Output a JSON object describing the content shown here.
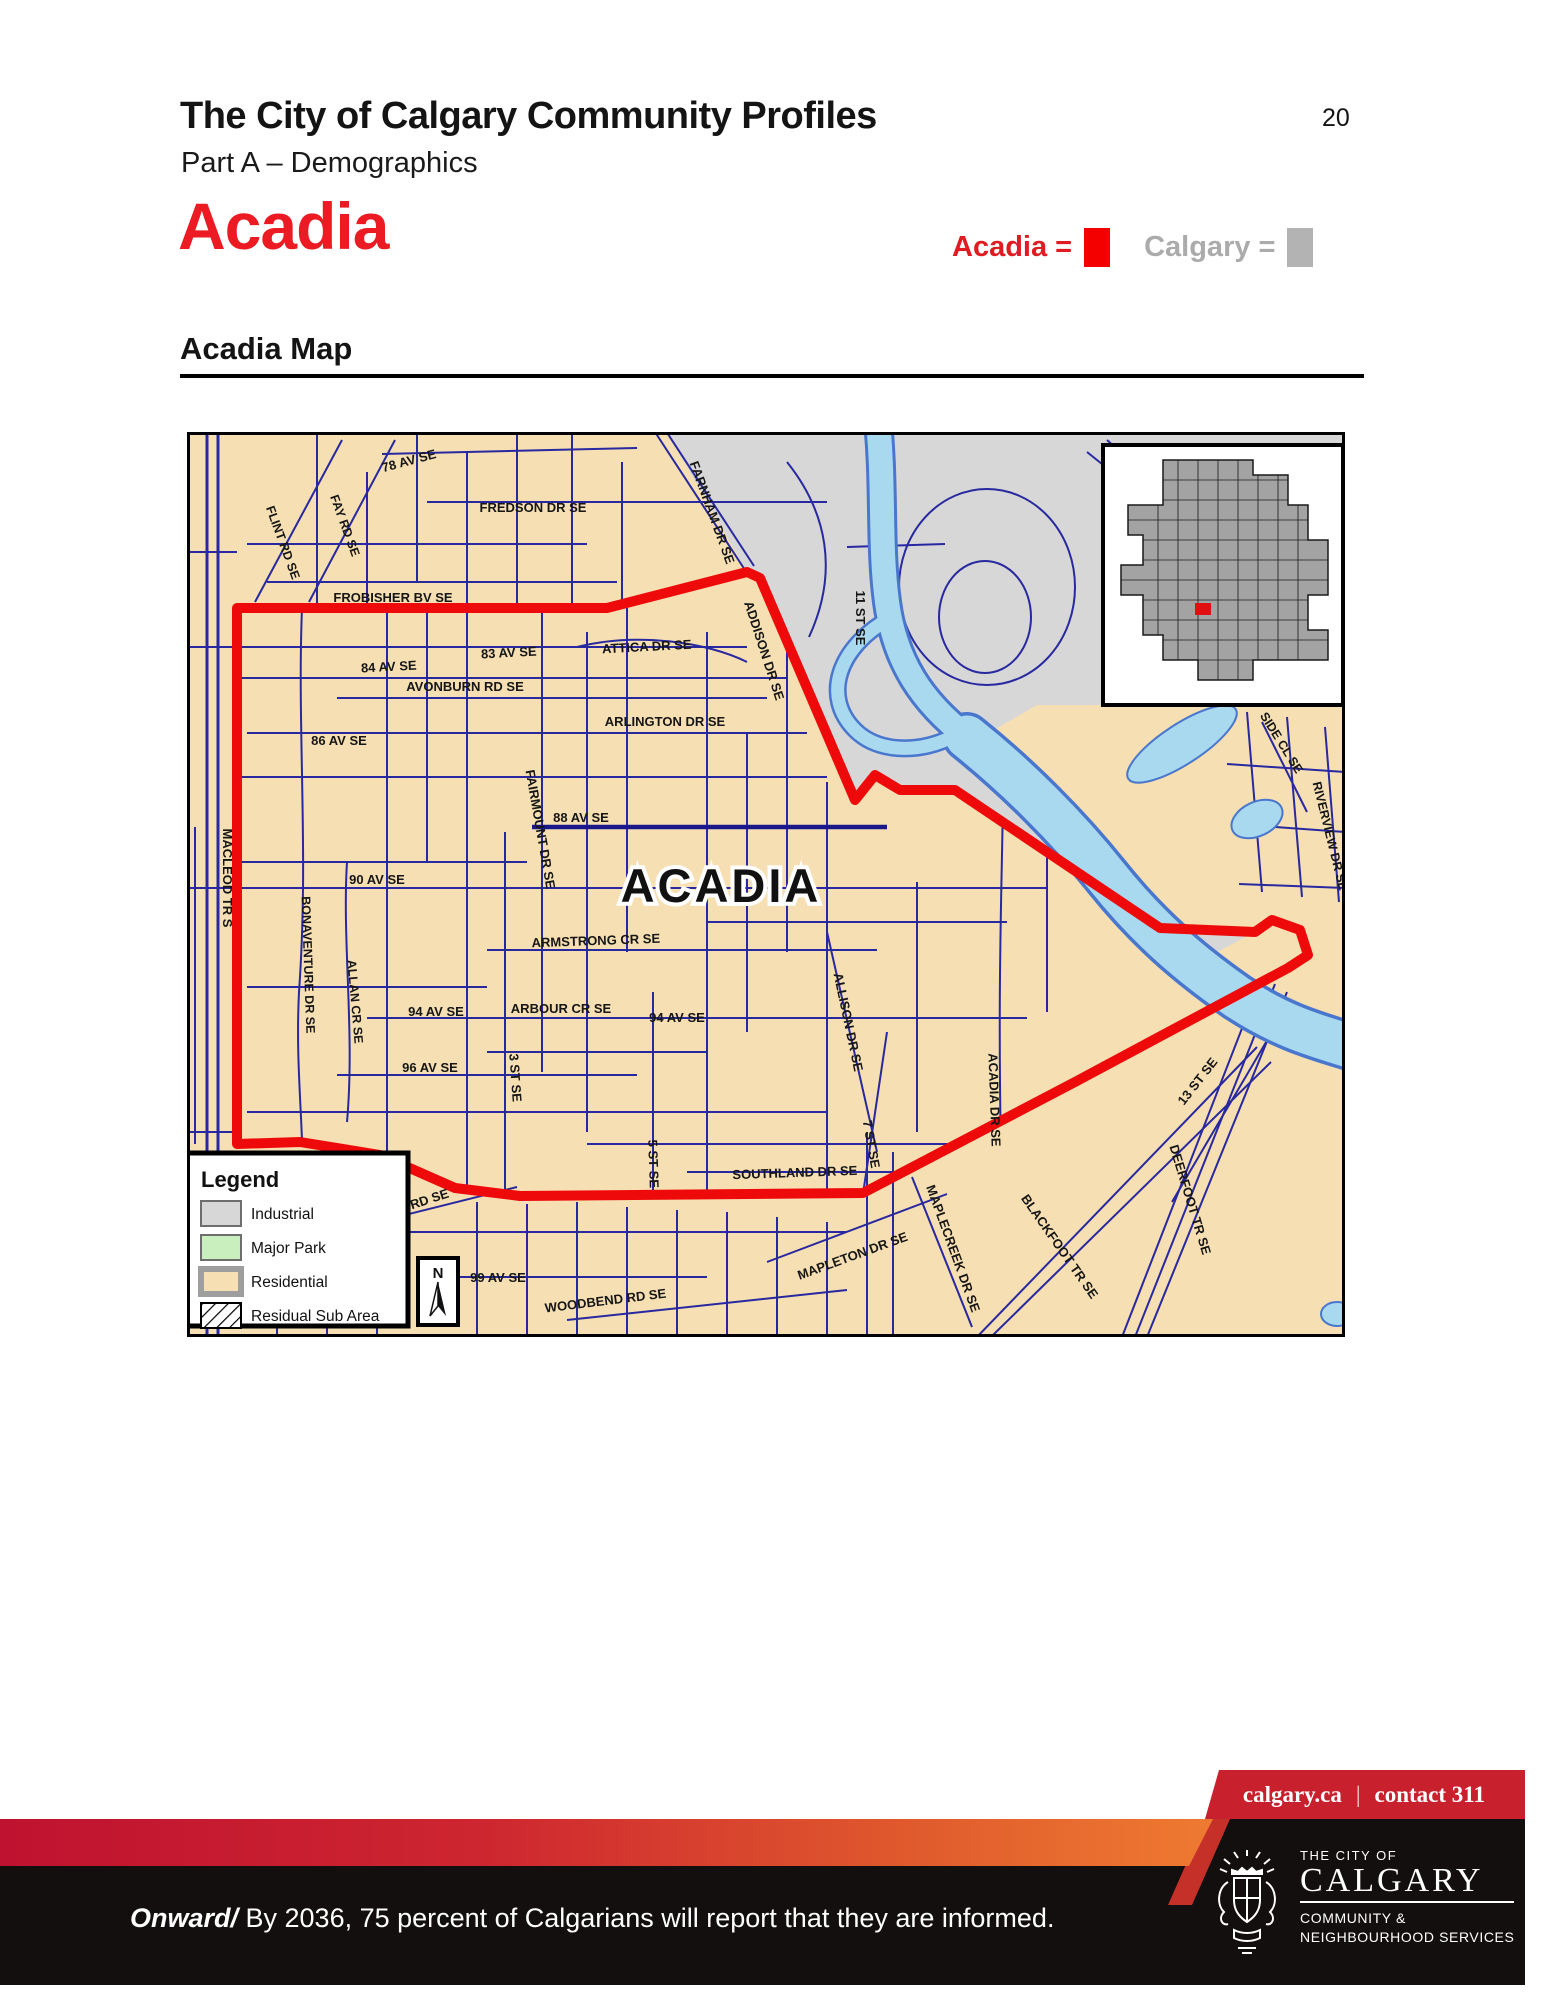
{
  "page": {
    "title": "The City of Calgary Community Profiles",
    "subtitle": "Part A – Demographics",
    "page_number": "20",
    "community_title": "Acadia",
    "map_heading": "Acadia Map"
  },
  "swatch_legend": {
    "acadia_label": "Acadia =",
    "calgary_label": "Calgary =",
    "acadia_color": "#f40000",
    "calgary_color": "#b3b3b3"
  },
  "map": {
    "community_label": "ACADIA",
    "colors": {
      "residential": "#f6dfb2",
      "industrial": "#d7d7d7",
      "major_park": "#c9efbe",
      "water_fill": "#a9d9ef",
      "water_edge": "#4a77ce",
      "street": "#2828a0",
      "boundary": "#ee0a0a"
    },
    "legend": {
      "title": "Legend",
      "items": [
        {
          "label": "Industrial"
        },
        {
          "label": "Major Park"
        },
        {
          "label": "Residential"
        },
        {
          "label": "Residual Sub Area"
        }
      ]
    },
    "north_label": "N",
    "street_labels": {
      "flint": "FLINT RD SE",
      "fay": "FAY RD SE",
      "av78": "78 AV SE",
      "fredson": "FREDSON DR SE",
      "farnham": "FARNHAM DR SE",
      "frobisher": "FROBISHER BV SE",
      "av83": "83 AV SE",
      "av84": "84 AV SE",
      "attica": "ATTICA DR SE",
      "addison": "ADDISON DR SE",
      "avonburn": "AVONBURN RD SE",
      "av86": "86 AV SE",
      "arlington": "ARLINGTON DR SE",
      "fairmount": "FAIRMOUNT DR SE",
      "av88": "88 AV SE",
      "st11": "11 ST SE",
      "macleod": "MACLEOD TR S",
      "av90": "90 AV SE",
      "bonaventure": "BONAVENTURE DR SE",
      "allan": "ALLAN CR SE",
      "armstrong": "ARMSTRONG CR SE",
      "arbour": "ARBOUR CR SE",
      "av94w": "94 AV SE",
      "av94e": "94 AV SE",
      "av96": "96 AV SE",
      "st3": "3 ST SE",
      "st5": "5 ST SE",
      "acadia_dr": "ACADIA DR SE",
      "allison": "ALLISON DR SE",
      "st7": "7 ST SE",
      "southland": "SOUTHLAND DR SE",
      "ght": "GHT RD SE",
      "av99": "99 AV SE",
      "woodbend": "WOODBEND RD SE",
      "mapleton": "MAPLETON DR SE",
      "maplecreek": "MAPLECREEK DR SE",
      "blackfoot": "BLACKFOOT TR SE",
      "deerfoot": "DEERFOOT TR SE",
      "st13": "13 ST SE",
      "riverview": "RIVERVIEW DR SE",
      "side_cl": "SIDE CL SE"
    }
  },
  "footer": {
    "site": "calgary.ca",
    "divider": "|",
    "contact": "contact 311",
    "onward_prefix": "Onward/",
    "onward_text": " By 2036, 75 percent of Calgarians will report that they are informed.",
    "logo_top": "THE CITY OF",
    "logo_name": "CALGARY",
    "logo_sub1": "COMMUNITY &",
    "logo_sub2": "NEIGHBOURHOOD SERVICES"
  }
}
